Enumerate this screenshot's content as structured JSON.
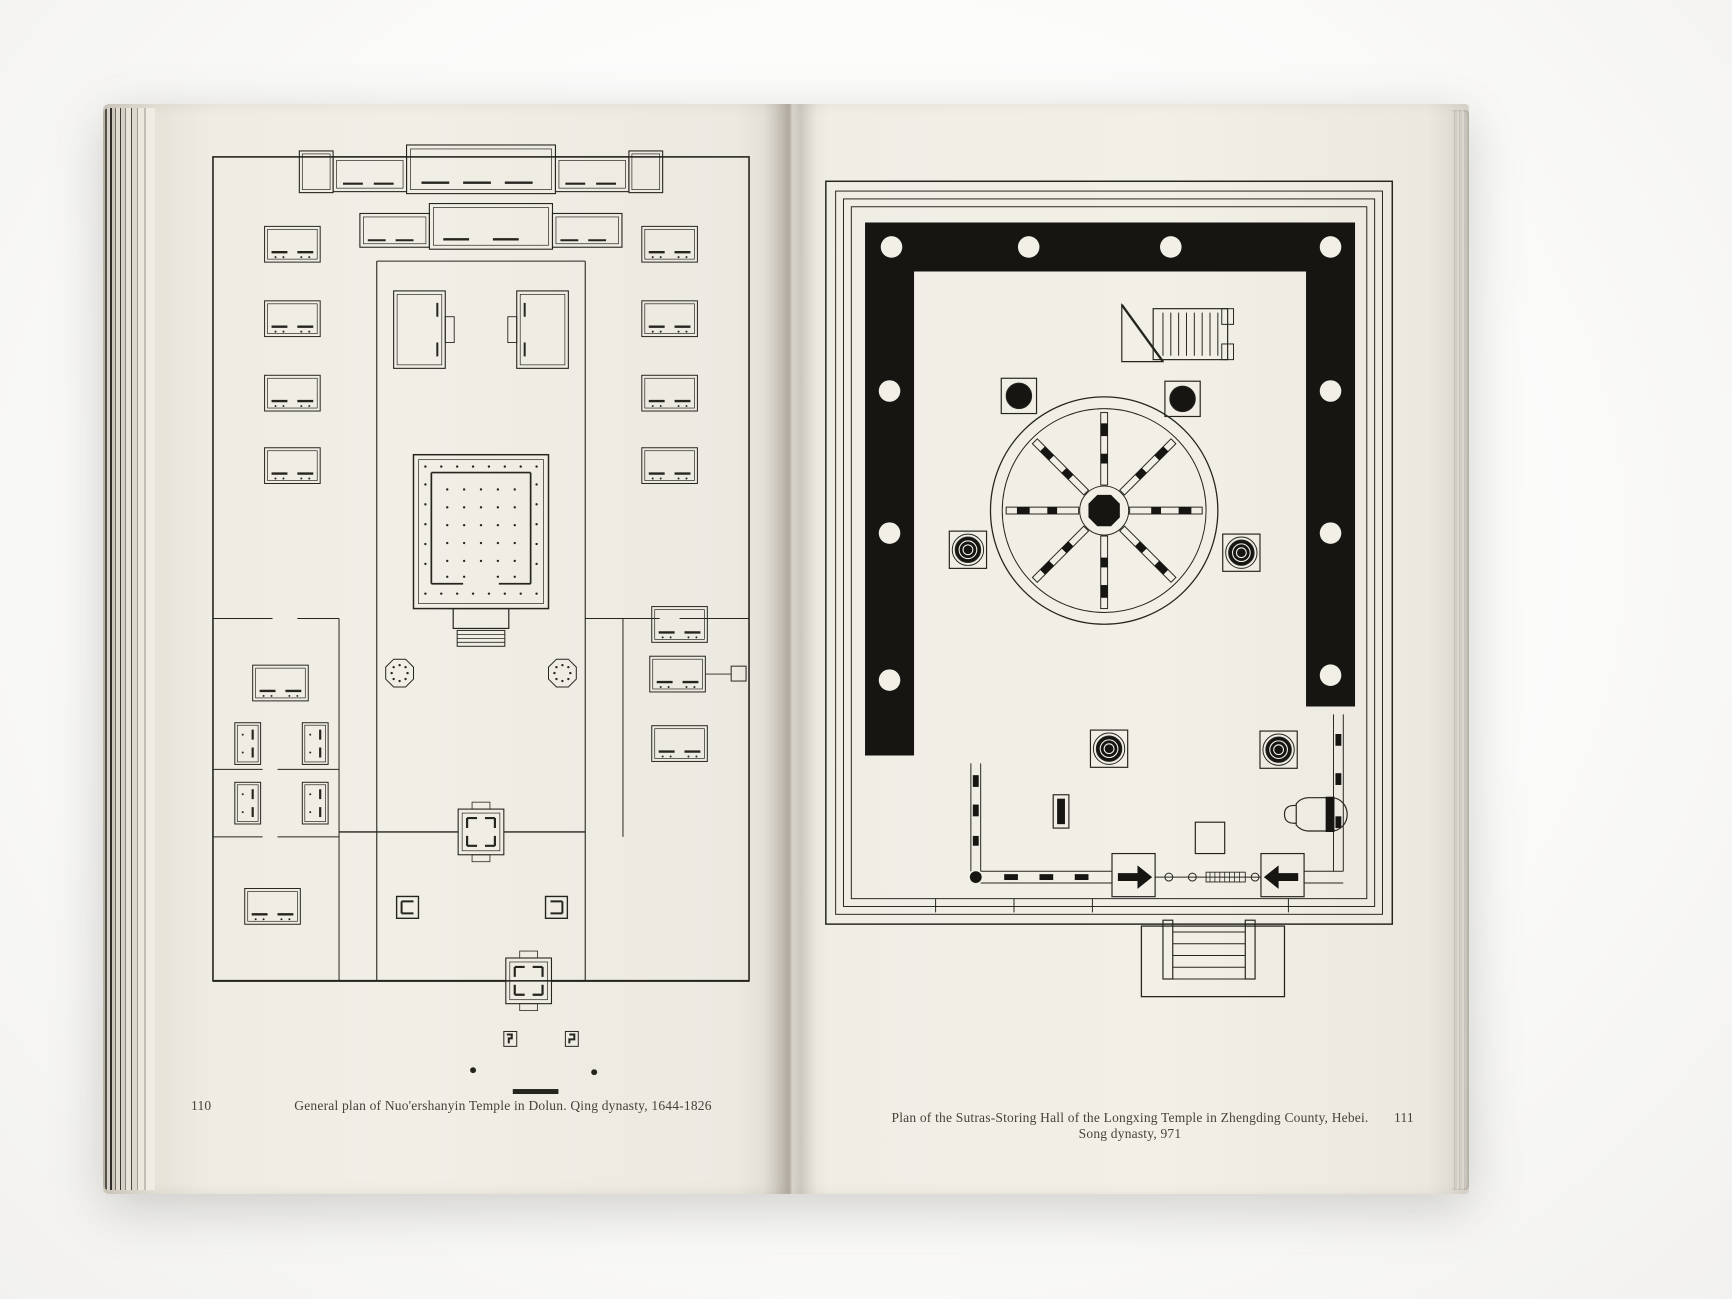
{
  "book": {
    "left_page": {
      "number": "110",
      "caption": "General plan of Nuo'ershanyin Temple in Dolun. Qing dynasty, 1644-1826",
      "plan_name": "general-plan-nuoershanyin-temple"
    },
    "right_page": {
      "number": "111",
      "caption": "Plan of the Sutras-Storing Hall of the Longxing Temple in Zhengding County, Hebei. Song dynasty, 971",
      "plan_name": "sutras-storing-hall-longxing-temple"
    },
    "colors": {
      "paper": "#f1eee6",
      "ink": "#26241f",
      "plan_black": "#161512",
      "background": "#fbfbfa"
    }
  }
}
